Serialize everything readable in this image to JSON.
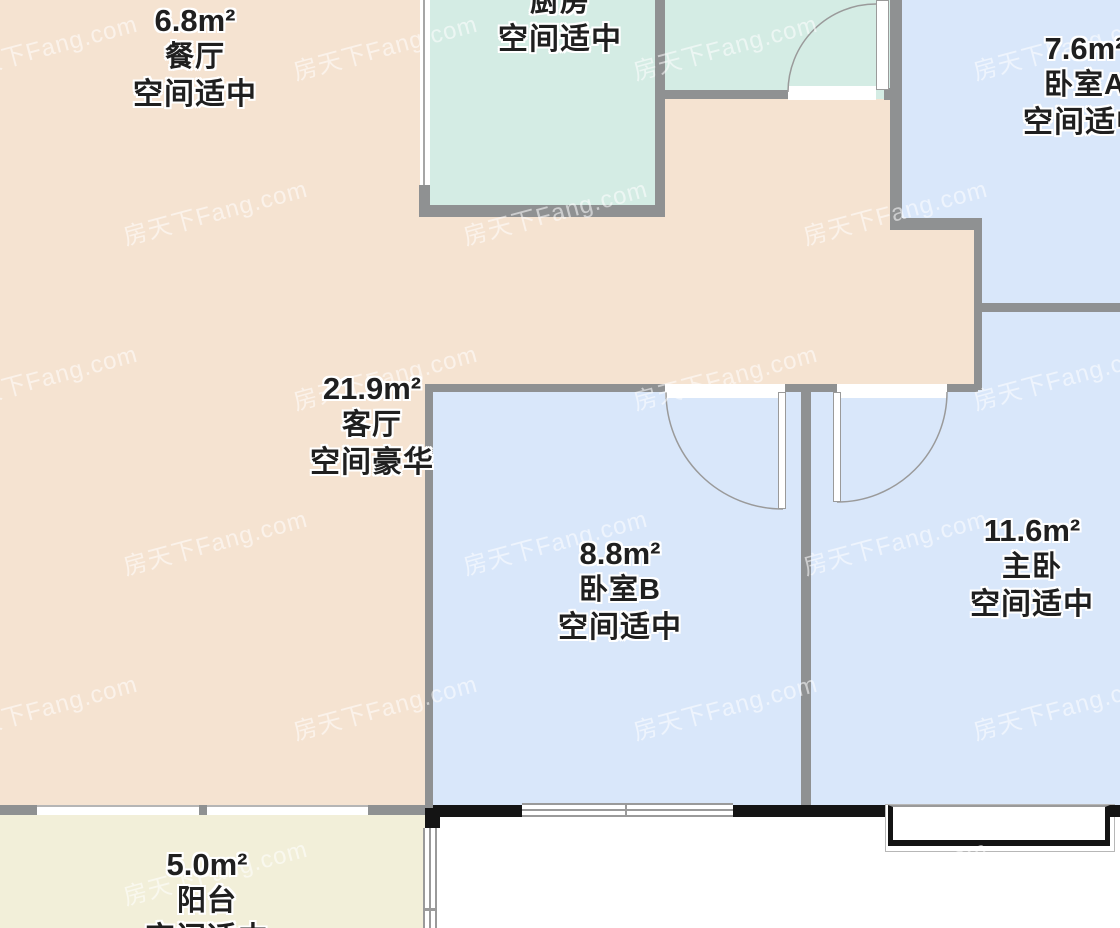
{
  "watermark": {
    "text": "房天下Fang.com"
  },
  "rooms": {
    "dining": {
      "area": "6.8m²",
      "name": "餐厅",
      "status": "空间适中"
    },
    "kitchen": {
      "name": "厨房",
      "status": "空间适中"
    },
    "bedroom_a": {
      "area": "7.6m²",
      "name": "卧室A",
      "status": "空间适中"
    },
    "living": {
      "area": "21.9m²",
      "name": "客厅",
      "status": "空间豪华"
    },
    "bedroom_b": {
      "area": "8.8m²",
      "name": "卧室B",
      "status": "空间适中"
    },
    "master": {
      "area": "11.6m²",
      "name": "主卧",
      "status": "空间适中"
    },
    "balcony": {
      "area": "5.0m²",
      "name": "阳台",
      "status": "空间适中"
    }
  },
  "colors": {
    "floor_living": "#f5e3d1",
    "floor_kitchen": "#d4ece4",
    "floor_bedroom": "#d9e7fa",
    "floor_balcony": "#f2efd9",
    "wall": "#8f9192",
    "wall_black": "#141414",
    "label_text": "#1f1f1f"
  }
}
